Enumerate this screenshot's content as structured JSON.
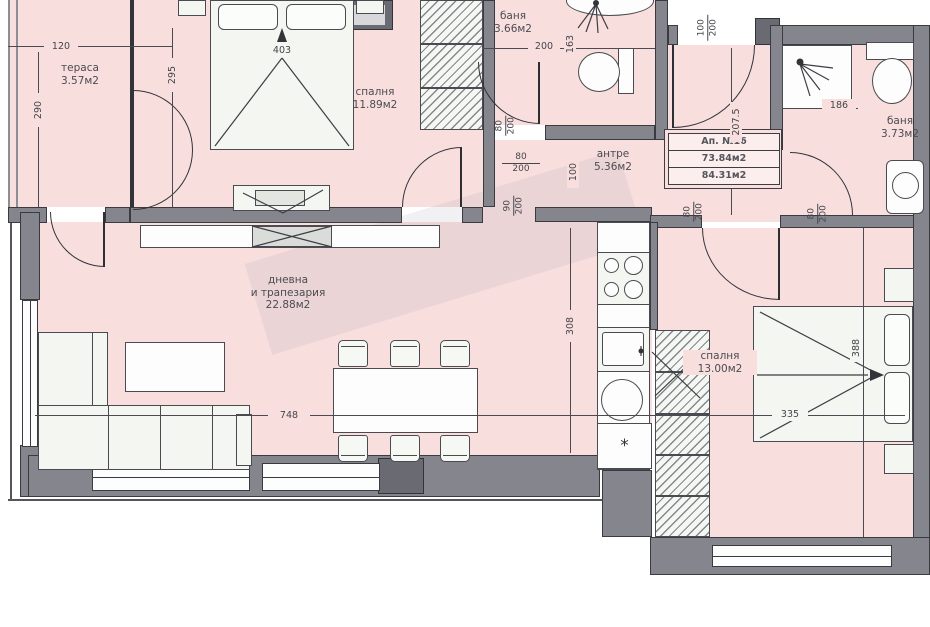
{
  "apartment": {
    "title": "Ап. №16",
    "area1": "73.84м2",
    "area2": "84.31м2"
  },
  "rooms": {
    "terrace": {
      "name": "тераса",
      "area": "3.57м2"
    },
    "bedroom1": {
      "name": "спалня",
      "area": "11.89м2"
    },
    "bath1": {
      "name": "баня",
      "area": "3.66м2"
    },
    "hall": {
      "name": "антре",
      "area": "5.36м2"
    },
    "bath2": {
      "name": "баня",
      "area": "3.73м2"
    },
    "living": {
      "name1": "дневна",
      "name2": "и трапезария",
      "area": "22.88м2"
    },
    "bedroom2": {
      "name": "спалня",
      "area": "13.00м2"
    }
  },
  "dims": {
    "terrace_w": "120",
    "terrace_h": "290",
    "wall_295": "295",
    "bed1_len": "403",
    "bath1_w": "200",
    "bath1_h": "163",
    "hall_w": "100",
    "hall_h": "207.5",
    "shower_w": "186",
    "kitchen_h": "308",
    "living_w": "748",
    "bed2_w": "335",
    "bed2_h": "388"
  },
  "doors": {
    "entry": {
      "w": "100",
      "h": "200"
    },
    "bath1": {
      "w": "80",
      "h": "200"
    },
    "bedroom1": {
      "w": "80",
      "h": "200"
    },
    "hall": {
      "w": "90",
      "h": "200"
    },
    "bedroom2": {
      "w": "80",
      "h": "200"
    },
    "bath2": {
      "w": "80",
      "h": "200"
    }
  },
  "symbols": {
    "fridge": "*"
  },
  "colors": {
    "room_fill": "#f8dfde",
    "wall": "#85858e",
    "line": "#33333a"
  }
}
